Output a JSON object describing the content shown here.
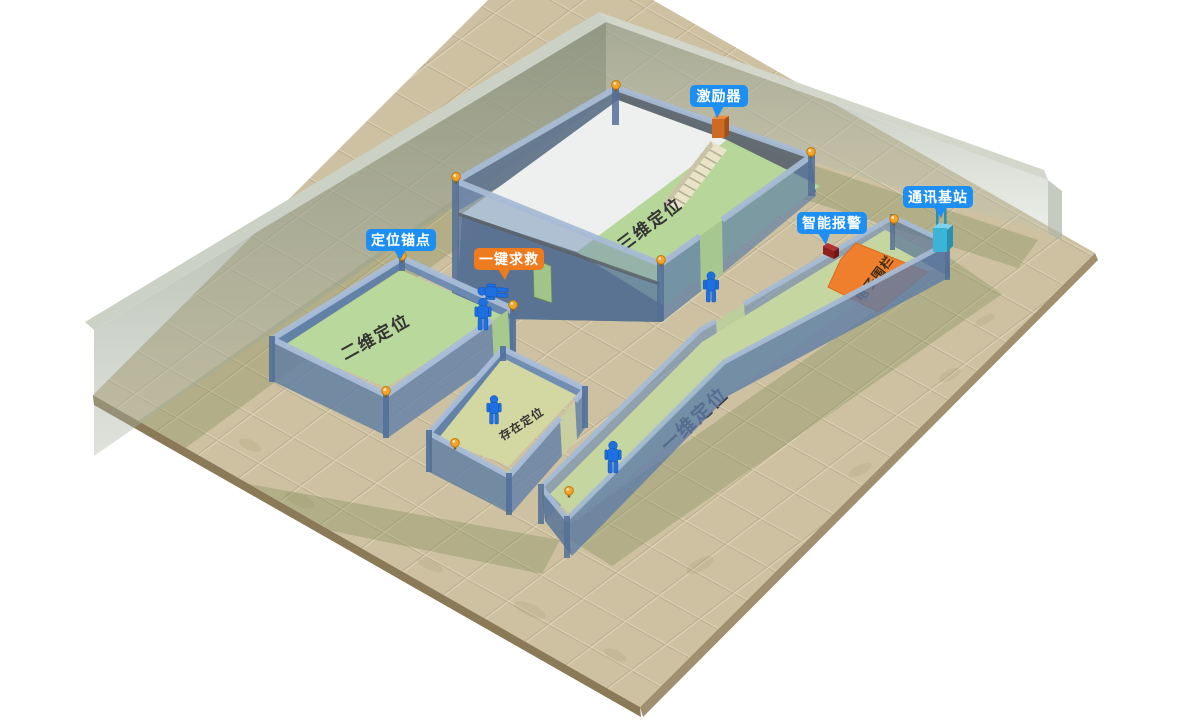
{
  "scene": {
    "description": "isometric indoor positioning system demo",
    "rooms": [
      {
        "id": "room-3d",
        "label": "三维定位"
      },
      {
        "id": "room-2d",
        "label": "二维定位"
      },
      {
        "id": "room-presence",
        "label": "存在定位"
      },
      {
        "id": "corridor-1d",
        "label": "一维定位"
      },
      {
        "id": "fence-zone",
        "label": "电子围栏"
      }
    ],
    "badges": [
      {
        "id": "exciter",
        "label": "激励器",
        "color": "#1d8ff2"
      },
      {
        "id": "anchor-point",
        "label": "定位锚点",
        "color": "#1d8ff2"
      },
      {
        "id": "sos",
        "label": "一键求救",
        "color": "#ee7b1e"
      },
      {
        "id": "smart-alarm",
        "label": "智能报警",
        "color": "#1d8ff2"
      },
      {
        "id": "comm-base-station",
        "label": "通讯基站",
        "color": "#1d8ff2"
      }
    ],
    "colors": {
      "badge_blue": "#1d8ff2",
      "badge_orange": "#ee7b1e",
      "fence_orange": "#ef7f2d",
      "wall_blue": "#6c8cb4",
      "room_floor_green": "#b7d69a",
      "ground_tan": "#cdc1a1",
      "person_blue": "#1e6fe0",
      "anchor_orange": "#f5a425"
    },
    "counts": {
      "persons_standing": 4,
      "persons_fallen": 1,
      "anchors": 10
    }
  }
}
